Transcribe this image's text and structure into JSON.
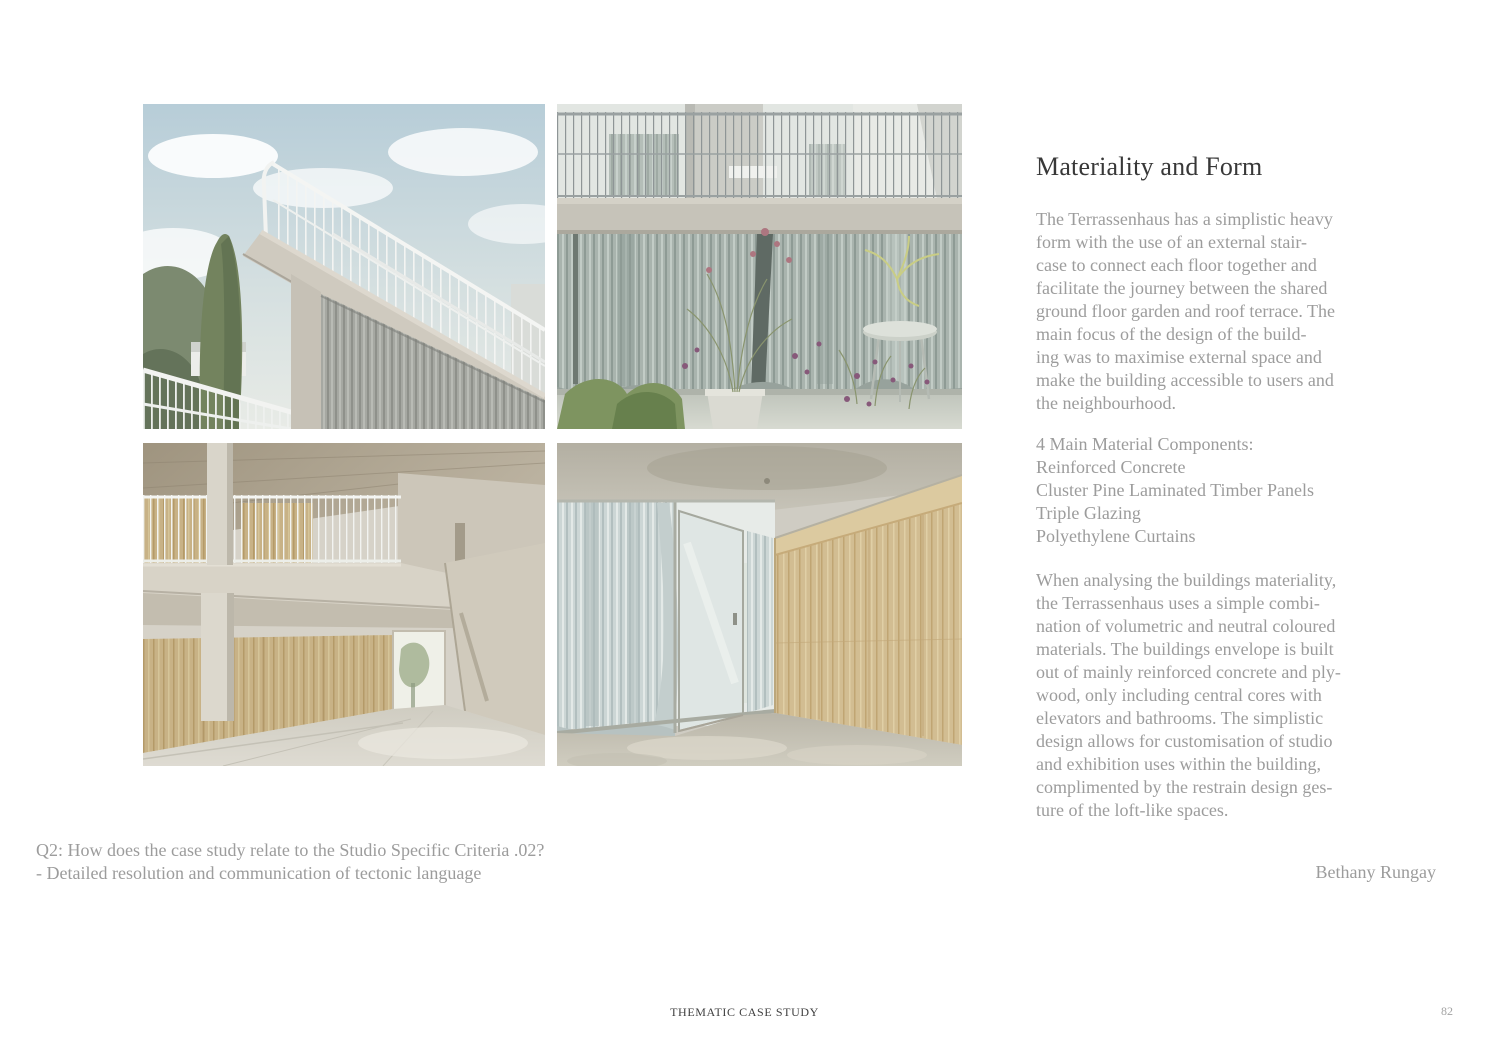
{
  "colors": {
    "page_background": "#ffffff",
    "heading_text": "#383838",
    "body_text": "#9c9c9c",
    "footer_text": "#3f3f3f"
  },
  "article": {
    "title": "Materiality and Form",
    "paragraph_1": "The Terrassenhaus has a simplistic heavy\nform with the use of an external stair-\ncase to connect each floor together and\nfacilitate the journey between the shared\nground floor garden and roof terrace. The\nmain focus of the design of the build-\ning was to maximise external space and\nmake the building accessible to users and\nthe neighbourhood.",
    "materials_list": "4 Main Material Components:\nReinforced Concrete\nCluster Pine Laminated Timber Panels\nTriple Glazing\nPolyethylene Curtains",
    "paragraph_2": "When analysing the buildings materiality,\nthe Terrassenhaus uses a simple combi-\nnation of volumetric and neutral coloured\nmaterials. The buildings envelope is built\nout of mainly reinforced concrete and ply-\nwood, only including central cores with\nelevators and bathrooms. The simplistic\ndesign allows for customisation of studio\nand exhibition uses within the building,\ncomplimented by the restrain design ges-\nture of the loft-like spaces.",
    "author": "Bethany Rungay"
  },
  "question": "Q2: How does the case study relate to the Studio Specific Criteria .02?\n- Detailed resolution and communication of tectonic language",
  "footer": {
    "label": "THEMATIC CASE STUDY",
    "page_number": "82"
  },
  "photos": {
    "top_left": "exterior-staircase",
    "top_right": "terrace-curtains",
    "bottom_left": "interior-mezzanine",
    "bottom_right": "interior-plywood-room"
  }
}
